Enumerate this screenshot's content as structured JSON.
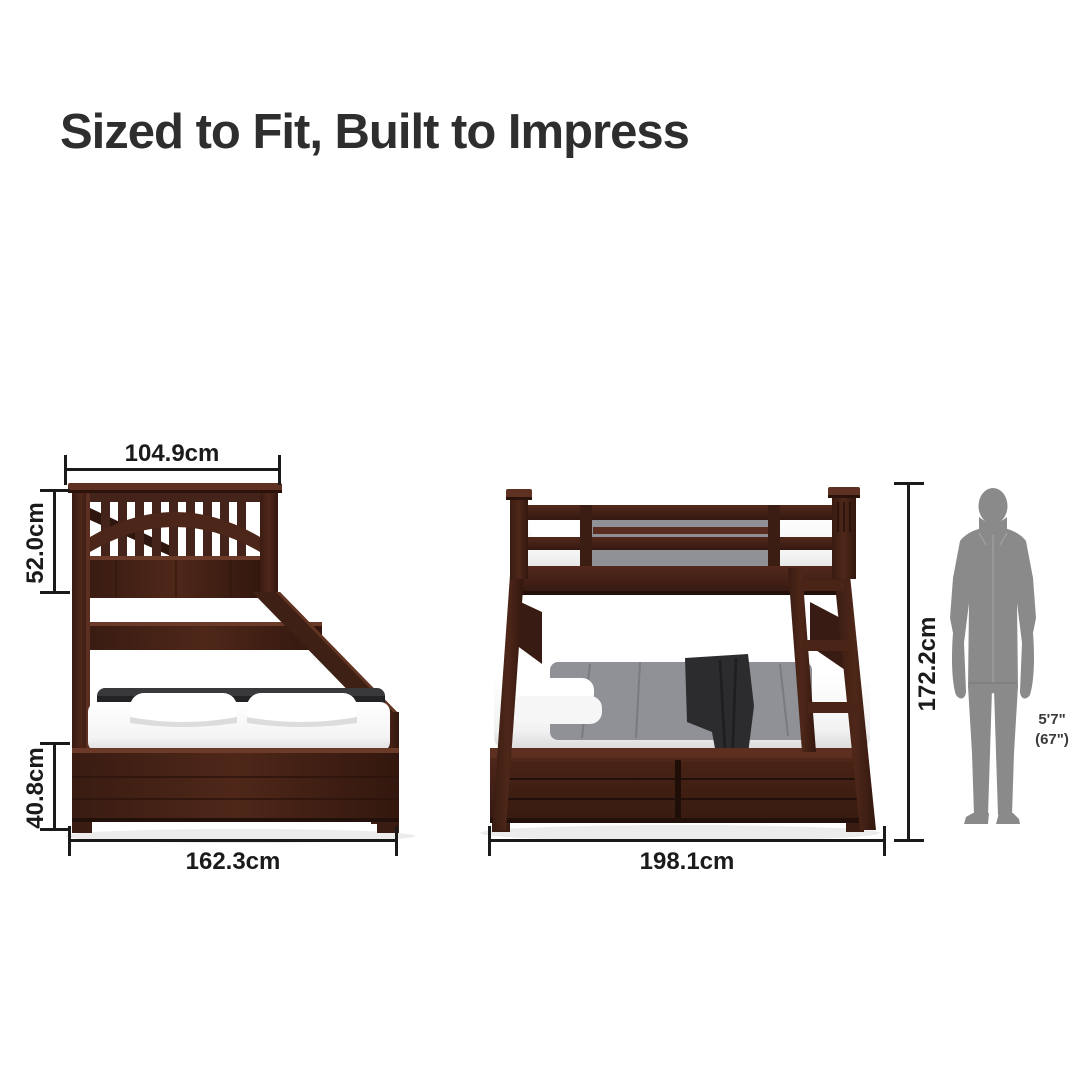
{
  "title": "Sized to Fit, Built to Impress",
  "front_view": {
    "name": "bunk bed front (end) view",
    "dims": {
      "top_width": "104.9cm",
      "upper_height": "52.0cm",
      "lower_height": "40.8cm",
      "bottom_width": "162.3cm"
    }
  },
  "side_view": {
    "name": "bunk bed side view",
    "dims": {
      "length": "198.1cm",
      "total_height": "172.2cm"
    }
  },
  "scale_figure": {
    "line1": "5'7\"",
    "line2": "(67\")"
  },
  "colors": {
    "wood": "#44231a",
    "wood_dark": "#2f160f",
    "wood_light": "#613226",
    "dimension_line": "#1a1a1a",
    "title_text": "#2e2e2e",
    "person": "#8a8a8a",
    "mattress": "#f8f8f8",
    "duvet_gray": "#8f9196",
    "throw_dark": "#2c2c2e",
    "shadow": "#ececec"
  }
}
